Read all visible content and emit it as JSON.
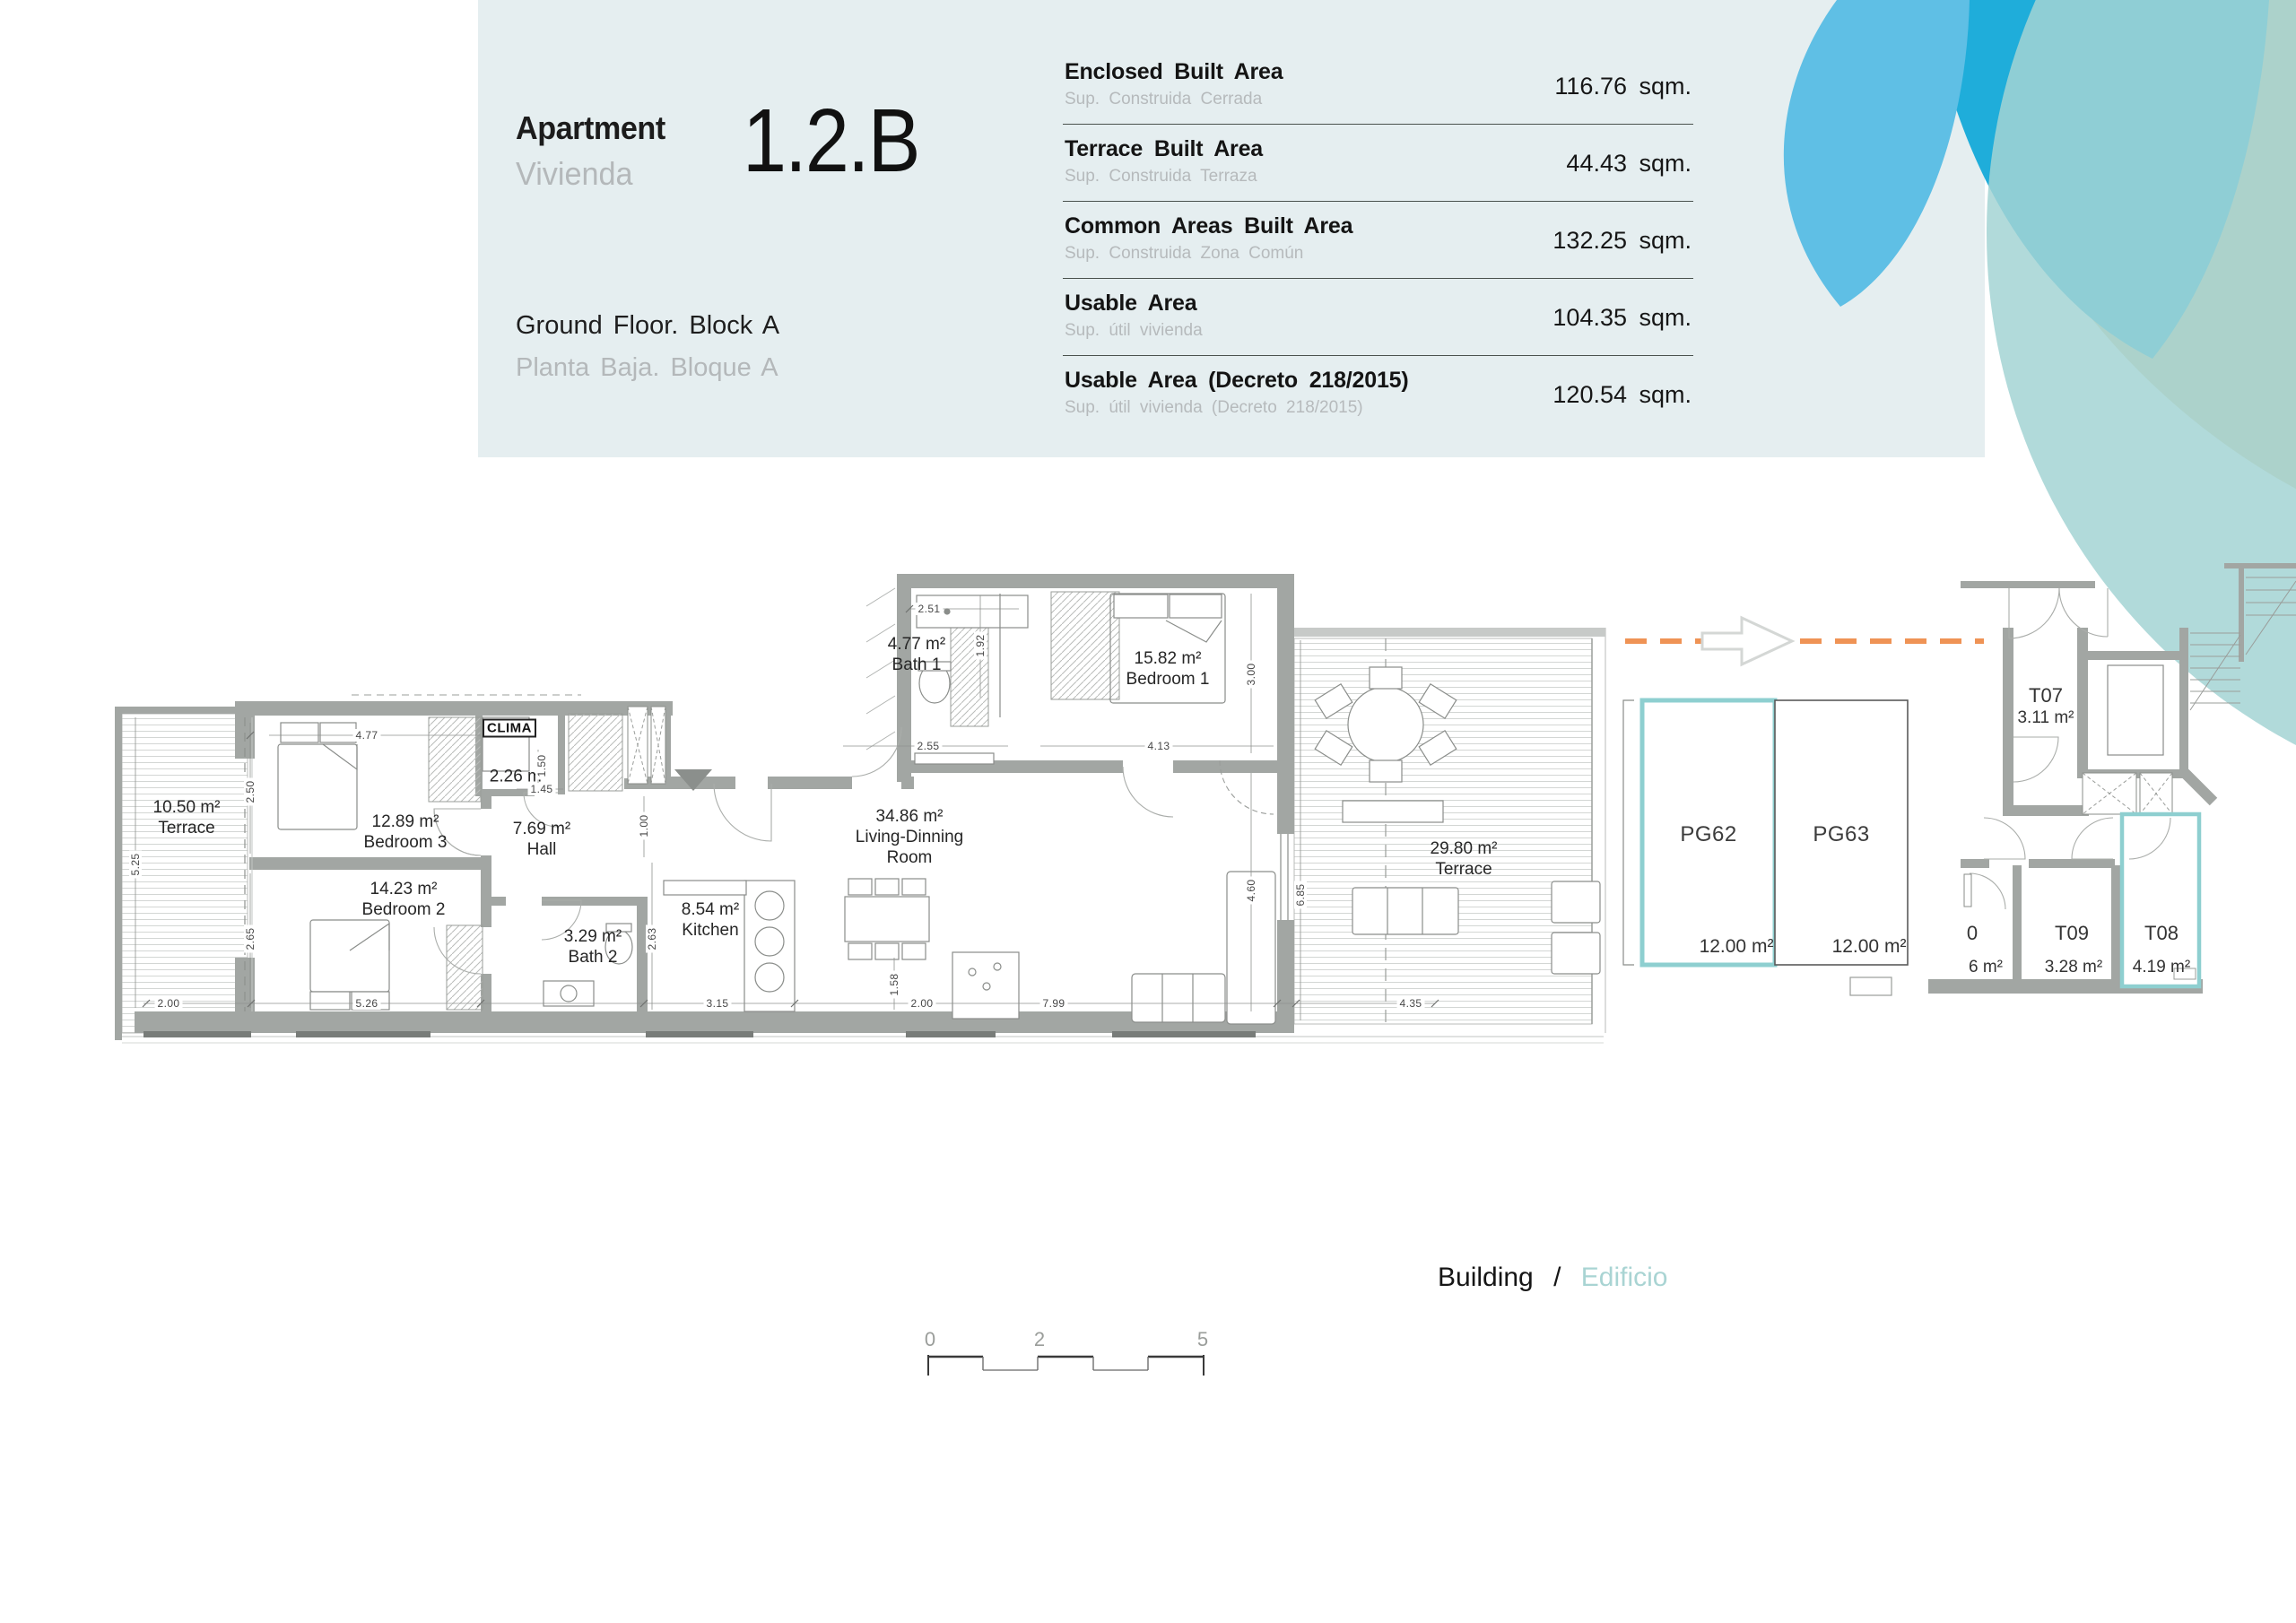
{
  "header": {
    "apartment_label": "Apartment",
    "apartment_label_es": "Vivienda",
    "unit": "1.2.B",
    "floor_label": "Ground Floor. Block A",
    "floor_label_es": "Planta Baja. Bloque A",
    "areas": [
      {
        "label": "Enclosed Built Area",
        "label_es": "Sup. Construida Cerrada",
        "value": "116.76 sqm."
      },
      {
        "label": "Terrace Built Area",
        "label_es": "Sup. Construida Terraza",
        "value": "44.43 sqm."
      },
      {
        "label": "Common Areas Built Area",
        "label_es": "Sup. Construida Zona Común",
        "value": "132.25 sqm."
      },
      {
        "label": "Usable Area",
        "label_es": "Sup. útil vivienda",
        "value": "104.35 sqm."
      },
      {
        "label": "Usable Area (Decreto 218/2015)",
        "label_es": "Sup. útil vivienda (Decreto 218/2015)",
        "value": "120.54 sqm."
      }
    ]
  },
  "plan": {
    "rooms": {
      "terrace_left": {
        "area": "10.50 m²",
        "name": "Terrace"
      },
      "bedroom3": {
        "area": "12.89 m²",
        "name": "Bedroom 3"
      },
      "bedroom2": {
        "area": "14.23 m²",
        "name": "Bedroom 2"
      },
      "clima": {
        "name": "CLIMA",
        "area": "2.26 m²"
      },
      "hall": {
        "area": "7.69 m²",
        "name": "Hall"
      },
      "bath2": {
        "area": "3.29 m²",
        "name": "Bath 2"
      },
      "kitchen": {
        "area": "8.54 m²",
        "name": "Kitchen"
      },
      "living": {
        "area": "34.86 m²",
        "name": "Living-Dinning Room"
      },
      "bath1": {
        "area": "4.77 m²",
        "name": "Bath 1"
      },
      "bedroom1": {
        "area": "15.82 m²",
        "name": "Bedroom 1"
      },
      "terrace_right": {
        "area": "29.80 m²",
        "name": "Terrace"
      }
    },
    "dims": {
      "d477": "4.77",
      "d250": "2.50",
      "d265": "2.65",
      "d525": "5.25",
      "d200a": "2.00",
      "d526": "5.26",
      "d150": "1.50",
      "d145": "1.45",
      "d100": "1.00",
      "d263": "2.63",
      "d315": "3.15",
      "d200b": "2.00",
      "d158": "1.58",
      "d799": "7.99",
      "d435": "4.35",
      "d251": "2.51",
      "d192": "1.92",
      "d255": "2.55",
      "d413": "4.13",
      "d300": "3.00",
      "d460": "4.60",
      "d685": "6.85"
    },
    "parking": {
      "spaces": [
        {
          "id": "PG62",
          "area": "12.00 m²",
          "highlighted": true
        },
        {
          "id": "PG63",
          "area": "12.00 m²",
          "highlighted": false
        }
      ]
    },
    "storage": {
      "units": [
        {
          "id": "T07",
          "area": "3.11 m²"
        },
        {
          "id": "T09",
          "area": "3.28 m²"
        },
        {
          "id": "T08",
          "area": "4.19 m²"
        }
      ],
      "partial": {
        "id": "0",
        "area": "6 m²"
      }
    }
  },
  "footer": {
    "building": "Building",
    "separator": "/",
    "building_es": "Edificio"
  },
  "scale_bar": {
    "ticks": [
      "0",
      "2",
      "5"
    ]
  },
  "colors": {
    "card_bg": "#e5eef0",
    "accent_teal": "#8ecfd0",
    "accent_orange": "#ef9355",
    "circle_lightblue": "#5fbfe5",
    "circle_cyan": "#1fadda",
    "circle_tan": "#d9cb9c",
    "circle_teal": "#a3d4d3",
    "wall_gray": "#a2a6a3"
  }
}
